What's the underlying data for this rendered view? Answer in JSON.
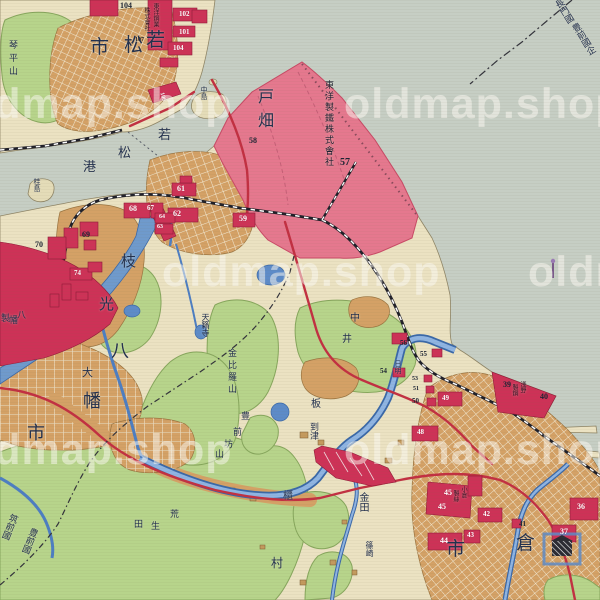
{
  "watermark": {
    "text": "oldmap.shop",
    "instances": [
      {
        "x": -46,
        "y": 80
      },
      {
        "x": 344,
        "y": 80
      },
      {
        "x": 162,
        "y": 248
      },
      {
        "x": 528,
        "y": 248
      },
      {
        "x": -46,
        "y": 426
      },
      {
        "x": 344,
        "y": 426
      }
    ]
  },
  "map": {
    "colors": {
      "sea": "#c6cec4",
      "land": "#ebe2c2",
      "green": "#b7d48b",
      "urban_tan": "#d4a166",
      "factory_red": "#cd3257",
      "reclaim_pink": "#e5788e",
      "river_blue": "#4d7ec2",
      "road_red": "#c23042",
      "rail_black": "#23232e",
      "label_navy": "#22304e"
    },
    "labels": [
      {
        "id": "wakamatsu-city",
        "size": 19,
        "chars": [
          {
            "c": "市",
            "x": 90,
            "y": 38
          },
          {
            "c": "松",
            "x": 124,
            "y": 36
          },
          {
            "c": "若",
            "x": 146,
            "y": 31
          }
        ]
      },
      {
        "id": "kotohirayama",
        "text": "琴平山",
        "v": 1,
        "x": 8,
        "y": 40,
        "size": 9,
        "ls": 4
      },
      {
        "id": "nakajima",
        "text": "中島",
        "v": 1,
        "x": 200,
        "y": 86,
        "size": 7
      },
      {
        "id": "katsurajima",
        "text": "桂島",
        "v": 1,
        "x": 33,
        "y": 178,
        "size": 7
      },
      {
        "id": "wakamatsu-port",
        "size": 13,
        "chars": [
          {
            "c": "若",
            "x": 158,
            "y": 128
          },
          {
            "c": "松",
            "x": 118,
            "y": 146
          },
          {
            "c": "港",
            "x": 83,
            "y": 160
          }
        ]
      },
      {
        "id": "tobata",
        "text": "戸畑",
        "v": 1,
        "x": 255,
        "y": 88,
        "size": 16,
        "ls": 8
      },
      {
        "id": "toyo-seitetsu",
        "text": "東洋製鐵株式會社",
        "v": 1,
        "x": 324,
        "y": 80,
        "size": 9,
        "color": "#1c2030",
        "ls": 2
      },
      {
        "id": "pier-company-1",
        "text": "東洋鋼業",
        "v": 1,
        "x": 152,
        "y": 3,
        "size": 6,
        "color": "#2a1020"
      },
      {
        "id": "pier-company-2",
        "text": "株式會社",
        "v": 1,
        "x": 143,
        "y": 7,
        "size": 6,
        "color": "#2a1020"
      },
      {
        "id": "edamitsu",
        "size": 15,
        "chars": [
          {
            "c": "枝",
            "x": 121,
            "y": 255
          },
          {
            "c": "光",
            "x": 99,
            "y": 298
          }
        ]
      },
      {
        "id": "yahata-city",
        "size": 18,
        "chars": [
          {
            "c": "八",
            "x": 111,
            "y": 342
          },
          {
            "c": "幡",
            "x": 83,
            "y": 392
          },
          {
            "c": "市",
            "x": 27,
            "y": 424
          }
        ]
      },
      {
        "id": "oaza-dai",
        "text": "大",
        "x": 82,
        "y": 368,
        "size": 11
      },
      {
        "id": "yahata-seitetsu",
        "size": 9,
        "chars": [
          {
            "c": "製",
            "x": 1,
            "y": 314
          },
          {
            "c": "幡",
            "x": 9,
            "y": 316
          },
          {
            "c": "八",
            "x": 17,
            "y": 311
          }
        ]
      },
      {
        "id": "tenraiji",
        "text": "天籟寺",
        "v": 1,
        "x": 201,
        "y": 313,
        "size": 8
      },
      {
        "id": "konpirayama",
        "text": "金比羅山",
        "v": 1,
        "x": 227,
        "y": 348,
        "size": 9,
        "ls": 3
      },
      {
        "id": "buzenbo-yama",
        "size": 9,
        "chars": [
          {
            "c": "豊",
            "x": 241,
            "y": 412
          },
          {
            "c": "前",
            "x": 233,
            "y": 428
          },
          {
            "c": "坊",
            "x": 224,
            "y": 440
          },
          {
            "c": "山",
            "x": 215,
            "y": 450
          }
        ]
      },
      {
        "id": "nakai",
        "size": 10,
        "chars": [
          {
            "c": "中",
            "x": 350,
            "y": 314
          },
          {
            "c": "井",
            "x": 342,
            "y": 335
          }
        ]
      },
      {
        "id": "itabitsu",
        "size": 10,
        "chars": [
          {
            "c": "板",
            "x": 311,
            "y": 400
          },
          {
            "c": "櫃",
            "x": 283,
            "y": 492
          }
        ]
      },
      {
        "id": "itozu",
        "text": "到津",
        "v": 1,
        "x": 309,
        "y": 422,
        "size": 9
      },
      {
        "id": "kanada",
        "text": "金田",
        "v": 1,
        "x": 357,
        "y": 492,
        "size": 10
      },
      {
        "id": "shinozaki",
        "text": "篠崎",
        "v": 1,
        "x": 365,
        "y": 541,
        "size": 8
      },
      {
        "id": "araota",
        "size": 9,
        "chars": [
          {
            "c": "荒",
            "x": 170,
            "y": 510
          },
          {
            "c": "生",
            "x": 151,
            "y": 522
          },
          {
            "c": "田",
            "x": 134,
            "y": 520
          }
        ]
      },
      {
        "id": "mura",
        "text": "村",
        "x": 271,
        "y": 557,
        "size": 12
      },
      {
        "id": "kokura-city",
        "size": 19,
        "chars": [
          {
            "c": "倉",
            "x": 516,
            "y": 534
          },
          {
            "c": "市",
            "x": 446,
            "y": 540
          }
        ]
      },
      {
        "id": "hiagari",
        "text": "日明",
        "v": 1,
        "x": 394,
        "y": 360,
        "size": 7
      },
      {
        "id": "nagato-province",
        "text": "長門國",
        "v": 1,
        "x": 552,
        "y": 0,
        "size": 9,
        "rot": -32
      },
      {
        "id": "buzen-province-n",
        "text": "豊前國企",
        "v": 1,
        "x": 569,
        "y": 24,
        "size": 9,
        "rot": -32
      },
      {
        "id": "chikuzen-province",
        "text": "筑前國",
        "v": 1,
        "x": 10,
        "y": 514,
        "size": 9,
        "rot": 22
      },
      {
        "id": "buzen-province-s",
        "text": "豊前國",
        "v": 1,
        "x": 30,
        "y": 528,
        "size": 9,
        "rot": 22
      },
      {
        "id": "asano-1",
        "text": "淺野",
        "v": 1,
        "x": 519,
        "y": 381,
        "size": 6,
        "color": "#2a1020"
      },
      {
        "id": "asano-2",
        "text": "製鋼",
        "v": 1,
        "x": 511,
        "y": 384,
        "size": 6,
        "color": "#2a1020"
      },
      {
        "id": "kokura-seishi-1",
        "text": "小倉",
        "v": 1,
        "x": 460,
        "y": 486,
        "size": 6,
        "color": "#2a1020"
      },
      {
        "id": "kokura-seishi-2",
        "text": "製絲",
        "v": 1,
        "x": 452,
        "y": 490,
        "size": 6,
        "color": "#2a1020"
      }
    ],
    "numbers": [
      {
        "n": "104",
        "x": 120,
        "y": 2,
        "c": "b",
        "s": 8
      },
      {
        "n": "107",
        "x": 135,
        "y": 37,
        "c": "b",
        "s": 6
      },
      {
        "n": "102",
        "x": 179,
        "y": 11,
        "c": "w",
        "s": 7
      },
      {
        "n": "101",
        "x": 179,
        "y": 29,
        "c": "w",
        "s": 7
      },
      {
        "n": "104",
        "x": 173,
        "y": 45,
        "c": "w",
        "s": 7
      },
      {
        "n": "106",
        "x": 158,
        "y": 94,
        "c": "w",
        "s": 6,
        "rot": 75
      },
      {
        "n": "58",
        "x": 249,
        "y": 137,
        "c": "b",
        "s": 8
      },
      {
        "n": "57",
        "x": 340,
        "y": 158,
        "c": "b",
        "s": 10
      },
      {
        "n": "61",
        "x": 177,
        "y": 185,
        "c": "w",
        "s": 8
      },
      {
        "n": "62",
        "x": 173,
        "y": 210,
        "c": "w",
        "s": 8
      },
      {
        "n": "68",
        "x": 129,
        "y": 205,
        "c": "w",
        "s": 8
      },
      {
        "n": "67",
        "x": 147,
        "y": 205,
        "c": "w",
        "s": 7
      },
      {
        "n": "64",
        "x": 159,
        "y": 214,
        "c": "w",
        "s": 6
      },
      {
        "n": "63",
        "x": 157,
        "y": 224,
        "c": "w",
        "s": 6
      },
      {
        "n": "59",
        "x": 239,
        "y": 215,
        "c": "w",
        "s": 8
      },
      {
        "n": "69",
        "x": 82,
        "y": 231,
        "c": "b",
        "s": 8
      },
      {
        "n": "70",
        "x": 35,
        "y": 241,
        "c": "b",
        "s": 8
      },
      {
        "n": "74",
        "x": 74,
        "y": 270,
        "c": "w",
        "s": 7
      },
      {
        "n": "56",
        "x": 400,
        "y": 340,
        "c": "b",
        "s": 7
      },
      {
        "n": "55",
        "x": 420,
        "y": 351,
        "c": "b",
        "s": 7
      },
      {
        "n": "54",
        "x": 380,
        "y": 368,
        "c": "b",
        "s": 7
      },
      {
        "n": "53",
        "x": 412,
        "y": 376,
        "c": "b",
        "s": 6
      },
      {
        "n": "51",
        "x": 413,
        "y": 386,
        "c": "b",
        "s": 6
      },
      {
        "n": "50",
        "x": 412,
        "y": 398,
        "c": "b",
        "s": 7
      },
      {
        "n": "49",
        "x": 442,
        "y": 395,
        "c": "w",
        "s": 7
      },
      {
        "n": "48",
        "x": 417,
        "y": 429,
        "c": "w",
        "s": 7
      },
      {
        "n": "39",
        "x": 503,
        "y": 381,
        "c": "b",
        "s": 8
      },
      {
        "n": "40",
        "x": 540,
        "y": 393,
        "c": "b",
        "s": 8
      },
      {
        "n": "45",
        "x": 444,
        "y": 489,
        "c": "w",
        "s": 8
      },
      {
        "n": "45",
        "x": 438,
        "y": 503,
        "c": "w",
        "s": 8
      },
      {
        "n": "42",
        "x": 483,
        "y": 511,
        "c": "w",
        "s": 7
      },
      {
        "n": "41",
        "x": 519,
        "y": 521,
        "c": "b",
        "s": 7
      },
      {
        "n": "43",
        "x": 467,
        "y": 532,
        "c": "w",
        "s": 7
      },
      {
        "n": "44",
        "x": 440,
        "y": 537,
        "c": "w",
        "s": 8
      },
      {
        "n": "36",
        "x": 577,
        "y": 503,
        "c": "w",
        "s": 8
      },
      {
        "n": "37",
        "x": 560,
        "y": 528,
        "c": "w",
        "s": 8
      }
    ]
  }
}
